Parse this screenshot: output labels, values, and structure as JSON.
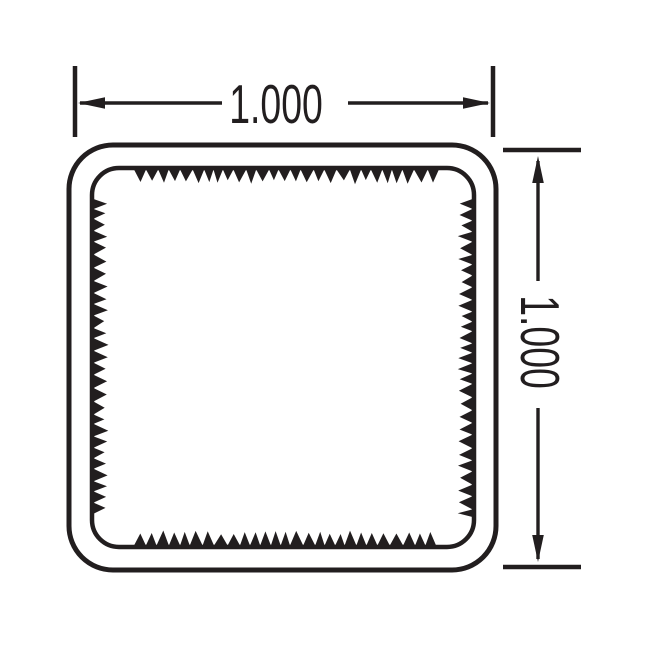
{
  "drawing": {
    "horizontal_dimension": {
      "label": "1.000"
    },
    "vertical_dimension": {
      "label": "1.000"
    }
  },
  "colors": {
    "ink": "#221e1f",
    "background": "#ffffff"
  }
}
